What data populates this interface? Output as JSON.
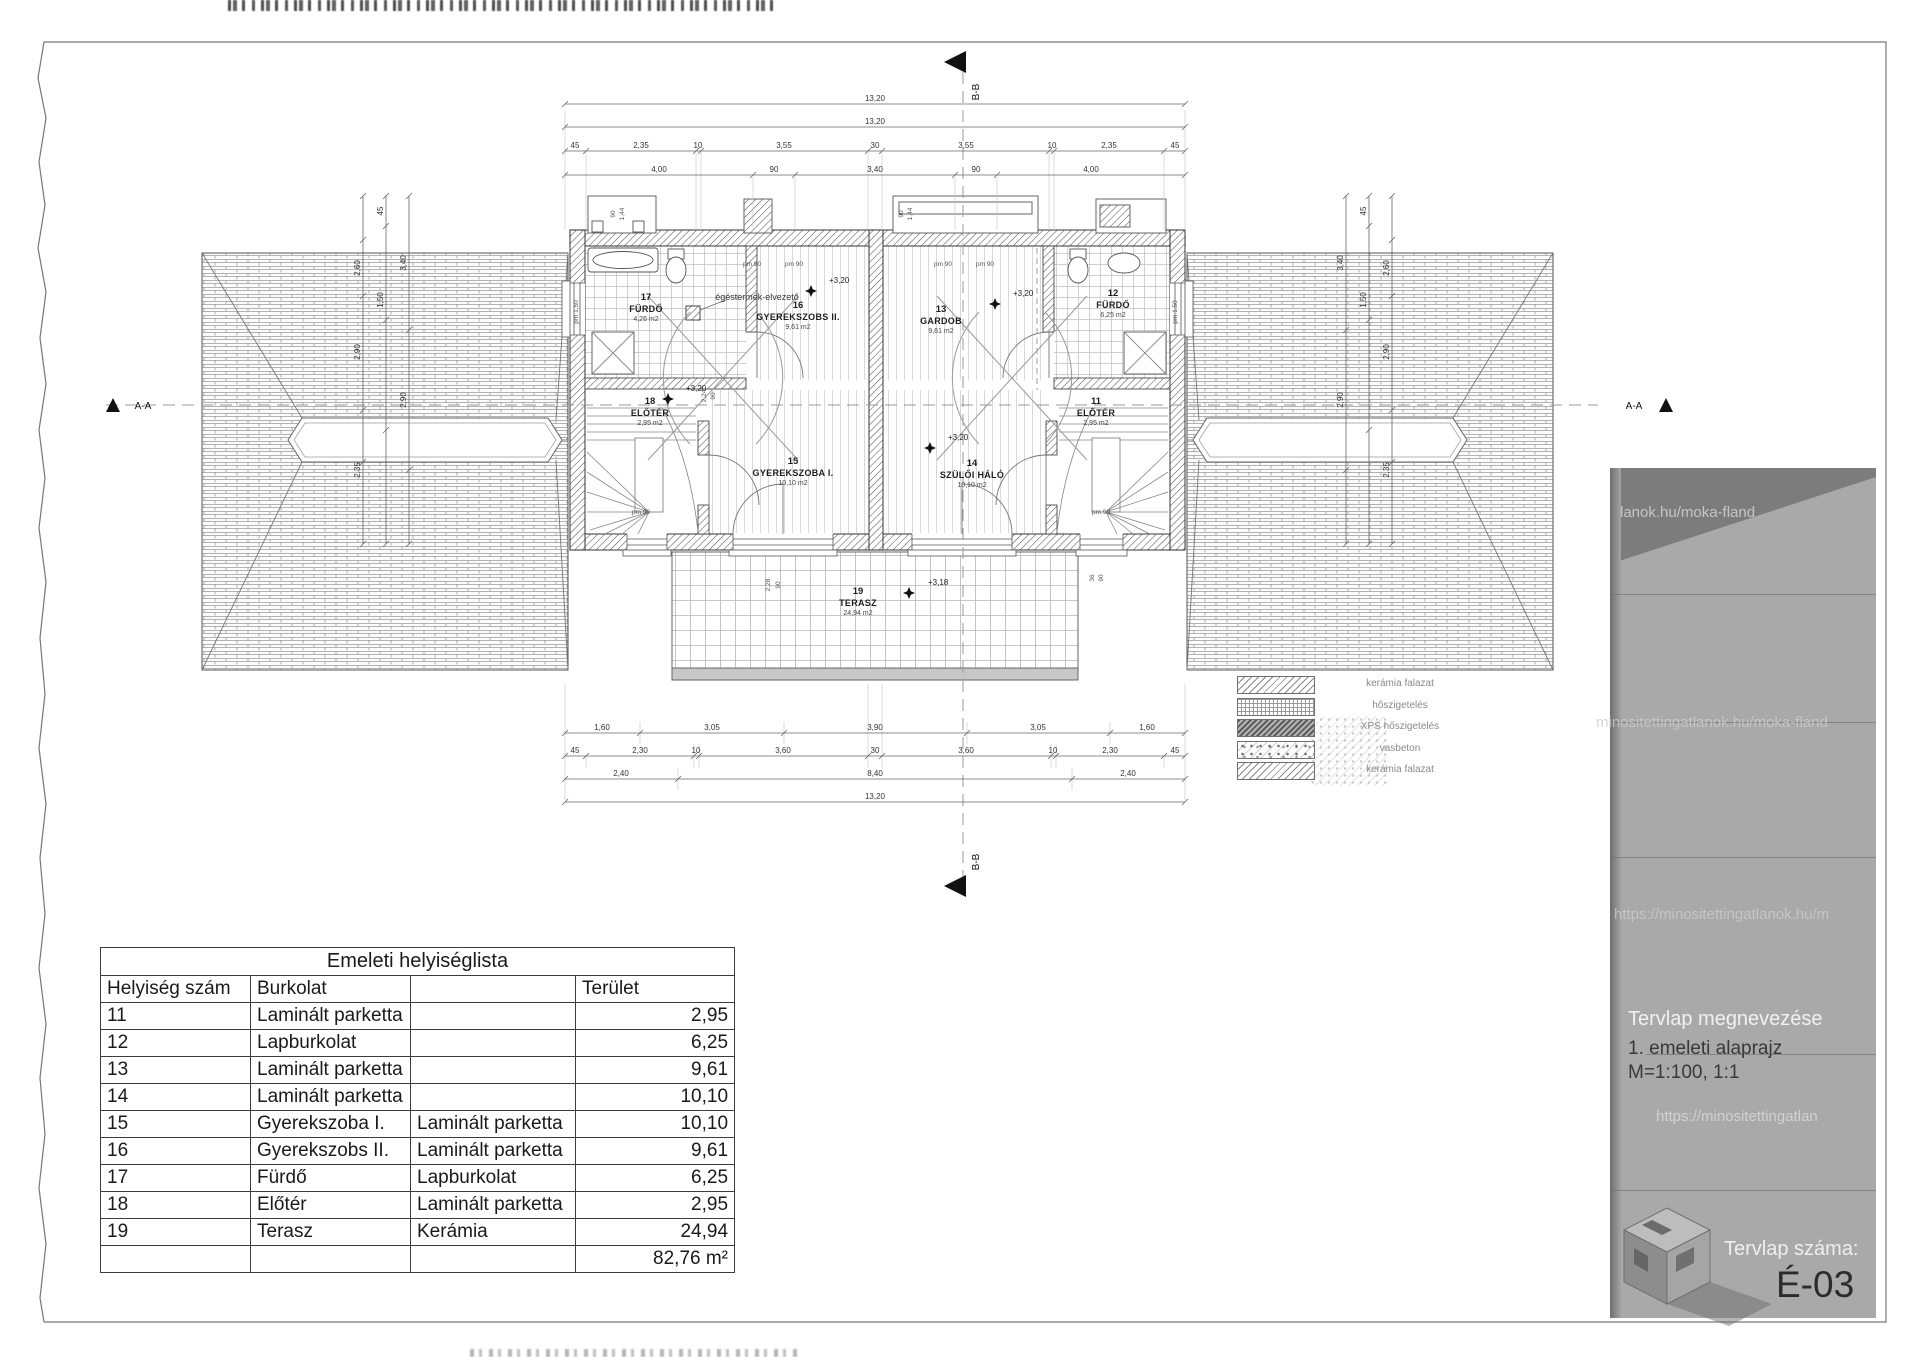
{
  "plan": {
    "section_a": "A-A",
    "section_b": "B-B",
    "flue_label": "égéstermék-elvezető",
    "rooms": [
      {
        "num": "17",
        "name": "FÜRDŐ",
        "area": "4,26 m2",
        "x": 646,
        "y": 300
      },
      {
        "num": "16",
        "name": "GYEREKSZOBS II.",
        "area": "9,61 m2",
        "x": 798,
        "y": 308
      },
      {
        "num": "13",
        "name": "GARDOB",
        "area": "9,61 m2",
        "x": 941,
        "y": 312
      },
      {
        "num": "12",
        "name": "FÜRDŐ",
        "area": "6,25 m2",
        "x": 1113,
        "y": 296
      },
      {
        "num": "18",
        "name": "ELŐTÉR",
        "area": "2,95 m2",
        "x": 650,
        "y": 404
      },
      {
        "num": "15",
        "name": "GYEREKSZOBA I.",
        "area": "10,10 m2",
        "x": 793,
        "y": 464
      },
      {
        "num": "14",
        "name": "SZÜLŐI HÁLÓ",
        "area": "10,10 m2",
        "x": 972,
        "y": 466
      },
      {
        "num": "11",
        "name": "ELŐTÉR",
        "area": "2,95 m2",
        "x": 1096,
        "y": 404
      },
      {
        "num": "19",
        "name": "TERASZ",
        "area": "24,94 m2",
        "x": 858,
        "y": 594
      }
    ],
    "levels": [
      {
        "t": "+3,20",
        "x": 829,
        "y": 283,
        "sx": 811,
        "sy": 291
      },
      {
        "t": "+3,20",
        "x": 686,
        "y": 391,
        "sx": 668,
        "sy": 399
      },
      {
        "t": "+3,20",
        "x": 1013,
        "y": 296,
        "sx": 995,
        "sy": 304
      },
      {
        "t": "+3,20",
        "x": 948,
        "y": 440,
        "sx": 930,
        "sy": 448
      },
      {
        "t": "+3,18",
        "x": 928,
        "y": 585,
        "sx": 909,
        "sy": 593
      }
    ],
    "pm_labels": [
      {
        "t": "pm 90",
        "x": 752,
        "y": 266
      },
      {
        "t": "pm 90",
        "x": 794,
        "y": 266
      },
      {
        "t": "pm 90",
        "x": 943,
        "y": 266
      },
      {
        "t": "pm 90",
        "x": 985,
        "y": 266
      },
      {
        "t": "pm 90",
        "x": 641,
        "y": 514
      },
      {
        "t": "pm 90",
        "x": 1101,
        "y": 514
      }
    ],
    "rotated_labels": [
      {
        "t": "pm 1,50",
        "x": 578,
        "y": 312
      },
      {
        "t": "pm 1,50",
        "x": 1177,
        "y": 312
      },
      {
        "t": "90",
        "x": 615,
        "y": 214
      },
      {
        "t": "1,44",
        "x": 624,
        "y": 214
      },
      {
        "t": "90",
        "x": 903,
        "y": 214
      },
      {
        "t": "1,44",
        "x": 912,
        "y": 214
      },
      {
        "t": "2,28",
        "x": 770,
        "y": 585
      },
      {
        "t": "90",
        "x": 780,
        "y": 585
      },
      {
        "t": "36",
        "x": 1094,
        "y": 578
      },
      {
        "t": "90",
        "x": 1103,
        "y": 578
      },
      {
        "t": "2,24",
        "x": 706,
        "y": 396
      },
      {
        "t": "90",
        "x": 715,
        "y": 396
      }
    ],
    "dim_chains": [
      {
        "dir": "h",
        "y": 104,
        "ticks": [
          565,
          1185
        ],
        "labels": [
          {
            "x": 875,
            "t": "13,20"
          }
        ]
      },
      {
        "dir": "h",
        "y": 127,
        "ticks": [
          565,
          1185
        ],
        "labels": [
          {
            "x": 875,
            "t": "13,20"
          }
        ]
      },
      {
        "dir": "h",
        "y": 151,
        "ticks": [
          565,
          586,
          696,
          701,
          868,
          882,
          1049,
          1054,
          1164,
          1185
        ],
        "labels": [
          {
            "x": 575,
            "t": "45"
          },
          {
            "x": 641,
            "t": "2,35"
          },
          {
            "x": 698,
            "t": "10"
          },
          {
            "x": 784,
            "t": "3,55"
          },
          {
            "x": 875,
            "t": "30"
          },
          {
            "x": 966,
            "t": "3,55"
          },
          {
            "x": 1052,
            "t": "10"
          },
          {
            "x": 1109,
            "t": "2,35"
          },
          {
            "x": 1175,
            "t": "45"
          }
        ]
      },
      {
        "dir": "h",
        "y": 175,
        "ticks": [
          565,
          753,
          795,
          955,
          997,
          1185
        ],
        "labels": [
          {
            "x": 659,
            "t": "4,00"
          },
          {
            "x": 774,
            "t": "90"
          },
          {
            "x": 875,
            "t": "3,40"
          },
          {
            "x": 976,
            "t": "90"
          },
          {
            "x": 1091,
            "t": "4,00"
          }
        ]
      },
      {
        "dir": "h",
        "y": 733,
        "ticks": [
          565,
          640,
          784,
          967,
          1110,
          1185
        ],
        "labels": [
          {
            "x": 602,
            "t": "1,60"
          },
          {
            "x": 712,
            "t": "3,05"
          },
          {
            "x": 875,
            "t": "3,90"
          },
          {
            "x": 1038,
            "t": "3,05"
          },
          {
            "x": 1147,
            "t": "1,60"
          }
        ]
      },
      {
        "dir": "h",
        "y": 756,
        "ticks": [
          565,
          586,
          694,
          699,
          868,
          882,
          1051,
          1056,
          1164,
          1185
        ],
        "labels": [
          {
            "x": 575,
            "t": "45"
          },
          {
            "x": 640,
            "t": "2,30"
          },
          {
            "x": 696,
            "t": "10"
          },
          {
            "x": 783,
            "t": "3,60"
          },
          {
            "x": 875,
            "t": "30"
          },
          {
            "x": 966,
            "t": "3,60"
          },
          {
            "x": 1053,
            "t": "10"
          },
          {
            "x": 1110,
            "t": "2,30"
          },
          {
            "x": 1175,
            "t": "45"
          }
        ]
      },
      {
        "dir": "h",
        "y": 779,
        "ticks": [
          565,
          678,
          1072,
          1185
        ],
        "labels": [
          {
            "x": 621,
            "t": "2,40"
          },
          {
            "x": 875,
            "t": "8,40"
          },
          {
            "x": 1128,
            "t": "2,40"
          }
        ]
      },
      {
        "dir": "h",
        "y": 802,
        "ticks": [
          565,
          1185
        ],
        "labels": [
          {
            "x": 875,
            "t": "13,20"
          }
        ]
      },
      {
        "dir": "v",
        "x": 363,
        "ticks": [
          196,
          240,
          296,
          410,
          462,
          544
        ],
        "labels": [
          {
            "y": 268,
            "t": "2,60"
          },
          {
            "y": 352,
            "t": "2,90"
          },
          {
            "y": 470,
            "t": "2,35"
          }
        ]
      },
      {
        "dir": "v",
        "x": 386,
        "ticks": [
          196,
          226,
          320,
          430,
          544
        ],
        "labels": [
          {
            "y": 211,
            "t": "45"
          },
          {
            "y": 300,
            "t": "1,50"
          }
        ]
      },
      {
        "dir": "v",
        "x": 409,
        "ticks": [
          196,
          330,
          470,
          544
        ],
        "labels": [
          {
            "y": 263,
            "t": "3,40"
          },
          {
            "y": 400,
            "t": "2,90"
          }
        ]
      },
      {
        "dir": "v",
        "x": 1392,
        "ticks": [
          196,
          240,
          296,
          410,
          462,
          544
        ],
        "labels": [
          {
            "y": 268,
            "t": "2,60"
          },
          {
            "y": 352,
            "t": "2,90"
          },
          {
            "y": 470,
            "t": "2,35"
          }
        ]
      },
      {
        "dir": "v",
        "x": 1369,
        "ticks": [
          196,
          226,
          320,
          430,
          544
        ],
        "labels": [
          {
            "y": 211,
            "t": "45"
          },
          {
            "y": 300,
            "t": "1,50"
          }
        ]
      },
      {
        "dir": "v",
        "x": 1346,
        "ticks": [
          196,
          330,
          470,
          544
        ],
        "labels": [
          {
            "y": 263,
            "t": "3,40"
          },
          {
            "y": 400,
            "t": "2,90"
          }
        ]
      }
    ]
  },
  "legend": {
    "items": [
      {
        "label": "kerámia falazat",
        "pattern": "diag"
      },
      {
        "label": "hőszigetelés",
        "pattern": "grid"
      },
      {
        "label": "XPS hőszigetelés",
        "pattern": "dense"
      },
      {
        "label": "vasbeton",
        "pattern": "concrete"
      },
      {
        "label": "kerámia falazat",
        "pattern": "diag"
      }
    ]
  },
  "room_table": {
    "title": "Emeleti helyiséglista",
    "headers": [
      "Helyiség szám",
      "Burkolat",
      "",
      "Terület"
    ],
    "rows": [
      {
        "num": "11",
        "col2": "Laminált parketta",
        "col3": "",
        "area": "2,95"
      },
      {
        "num": "12",
        "col2": "Lapburkolat",
        "col3": "",
        "area": "6,25"
      },
      {
        "num": "13",
        "col2": "Laminált parketta",
        "col3": "",
        "area": "9,61"
      },
      {
        "num": "14",
        "col2": "Laminált parketta",
        "col3": "",
        "area": "10,10"
      },
      {
        "num": "15",
        "col2": "Gyerekszoba I.",
        "col3": "Laminált parketta",
        "area": "10,10"
      },
      {
        "num": "16",
        "col2": "Gyerekszobs II.",
        "col3": "Laminált parketta",
        "area": "9,61"
      },
      {
        "num": "17",
        "col2": "Fürdő",
        "col3": "Lapburkolat",
        "area": "6,25"
      },
      {
        "num": "18",
        "col2": "Előtér",
        "col3": "Laminált parketta",
        "area": "2,95"
      },
      {
        "num": "19",
        "col2": "Terasz",
        "col3": "Kerámia",
        "area": "24,94"
      }
    ],
    "total": "82,76 m²"
  },
  "title_block": {
    "name_label": "Tervlap megnevezése",
    "drawing_title": "1. emeleti alaprajz",
    "scale": "M=1:100, 1:1",
    "number_label": "Tervlap száma:",
    "number": "É-03",
    "watermarks": [
      "lanok.hu/moka-fland",
      "minositettingatlanok.hu/moka-fland",
      "https://minositettingatlanok.hu/m",
      "https://minositettingatlan"
    ]
  }
}
